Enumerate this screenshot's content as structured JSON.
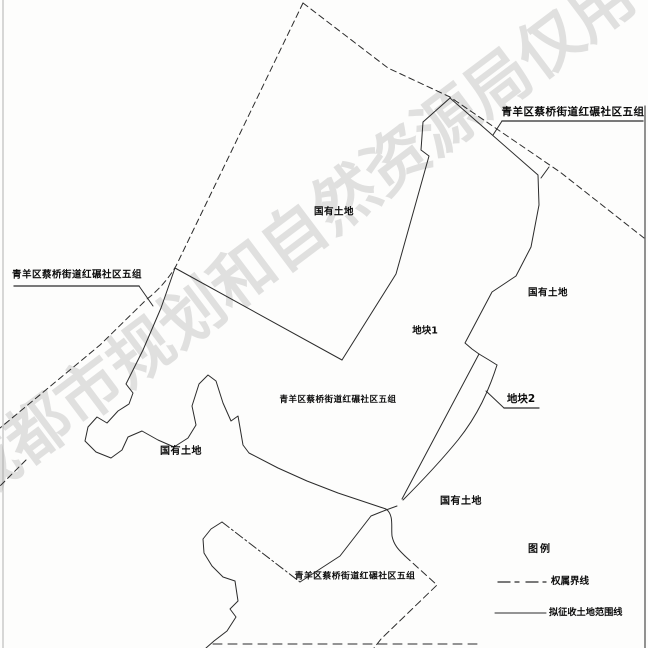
{
  "watermark": {
    "text": "成都市规划和自然资源局仅用于",
    "color": "#c9c9c9"
  },
  "boundary_owner_labels": {
    "left": "青羊区蔡桥街道红碾社区五组",
    "top_right": "青羊区蔡桥街道红碾社区五组",
    "central": "青羊区蔡桥街道红碾社区五组",
    "bottom": "青羊区蔡桥街道红碾社区五组"
  },
  "land_labels": {
    "upper": "国有土地",
    "right": "国有土地",
    "lower_left": "国有土地",
    "lower_center": "国有土地"
  },
  "parcels": {
    "parcel1": "地块1",
    "parcel2": "地块2"
  },
  "legend": {
    "title": "图例",
    "items": [
      {
        "label": "权属界线",
        "line_style": "dash-dot"
      },
      {
        "label": "拟征收土地范围线",
        "line_style": "solid"
      }
    ]
  },
  "colors": {
    "line": "#2b2b2b",
    "watermark": "#c9c9c9",
    "background": "#fdfdfc"
  }
}
